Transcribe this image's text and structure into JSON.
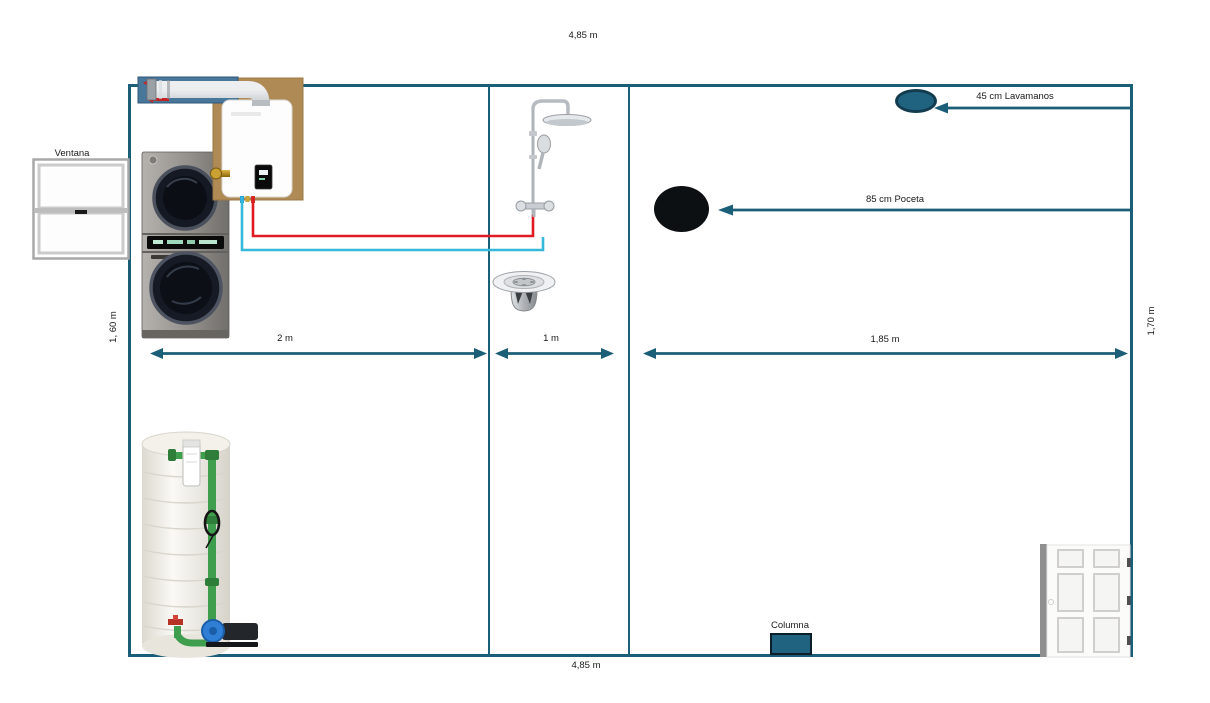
{
  "canvas": {
    "width": 1210,
    "height": 703,
    "background": "#ffffff"
  },
  "room": {
    "wall_color": "#1b5e78",
    "dimension_top": "4,85 m",
    "dimension_bottom": "4,85 m",
    "dimension_left": "1, 60 m",
    "dimension_right": "1,70 m",
    "sections": [
      {
        "width_label": "2 m"
      },
      {
        "width_label": "1 m"
      },
      {
        "width_label": "1,85 m"
      }
    ]
  },
  "labels": {
    "window": "Ventana",
    "column": "Columna",
    "sink_distance": "45 cm Lavamanos",
    "basin_distance": "85 cm Poceta"
  },
  "icons": [
    {
      "name": "window-icon"
    },
    {
      "name": "washer-dryer-stack-icon"
    },
    {
      "name": "water-heater-icon"
    },
    {
      "name": "flue-vent-icon"
    },
    {
      "name": "shower-column-icon"
    },
    {
      "name": "floor-drain-icon"
    },
    {
      "name": "sink-oval-icon"
    },
    {
      "name": "basin-oval-icon"
    },
    {
      "name": "water-tank-pump-icon"
    },
    {
      "name": "door-icon"
    },
    {
      "name": "column-block-icon"
    }
  ],
  "colors": {
    "wall": "#1b5e78",
    "arrow": "#1b5e78",
    "sink_fill": "#1f6380",
    "sink_border": "#133c4f",
    "basin_fill": "#0d1012",
    "column_fill": "#1f6380",
    "hot_water_pipe": "#e01b24",
    "cold_water_pipe": "#35b8d9",
    "tank_pipe_green": "#3f9e4d"
  }
}
